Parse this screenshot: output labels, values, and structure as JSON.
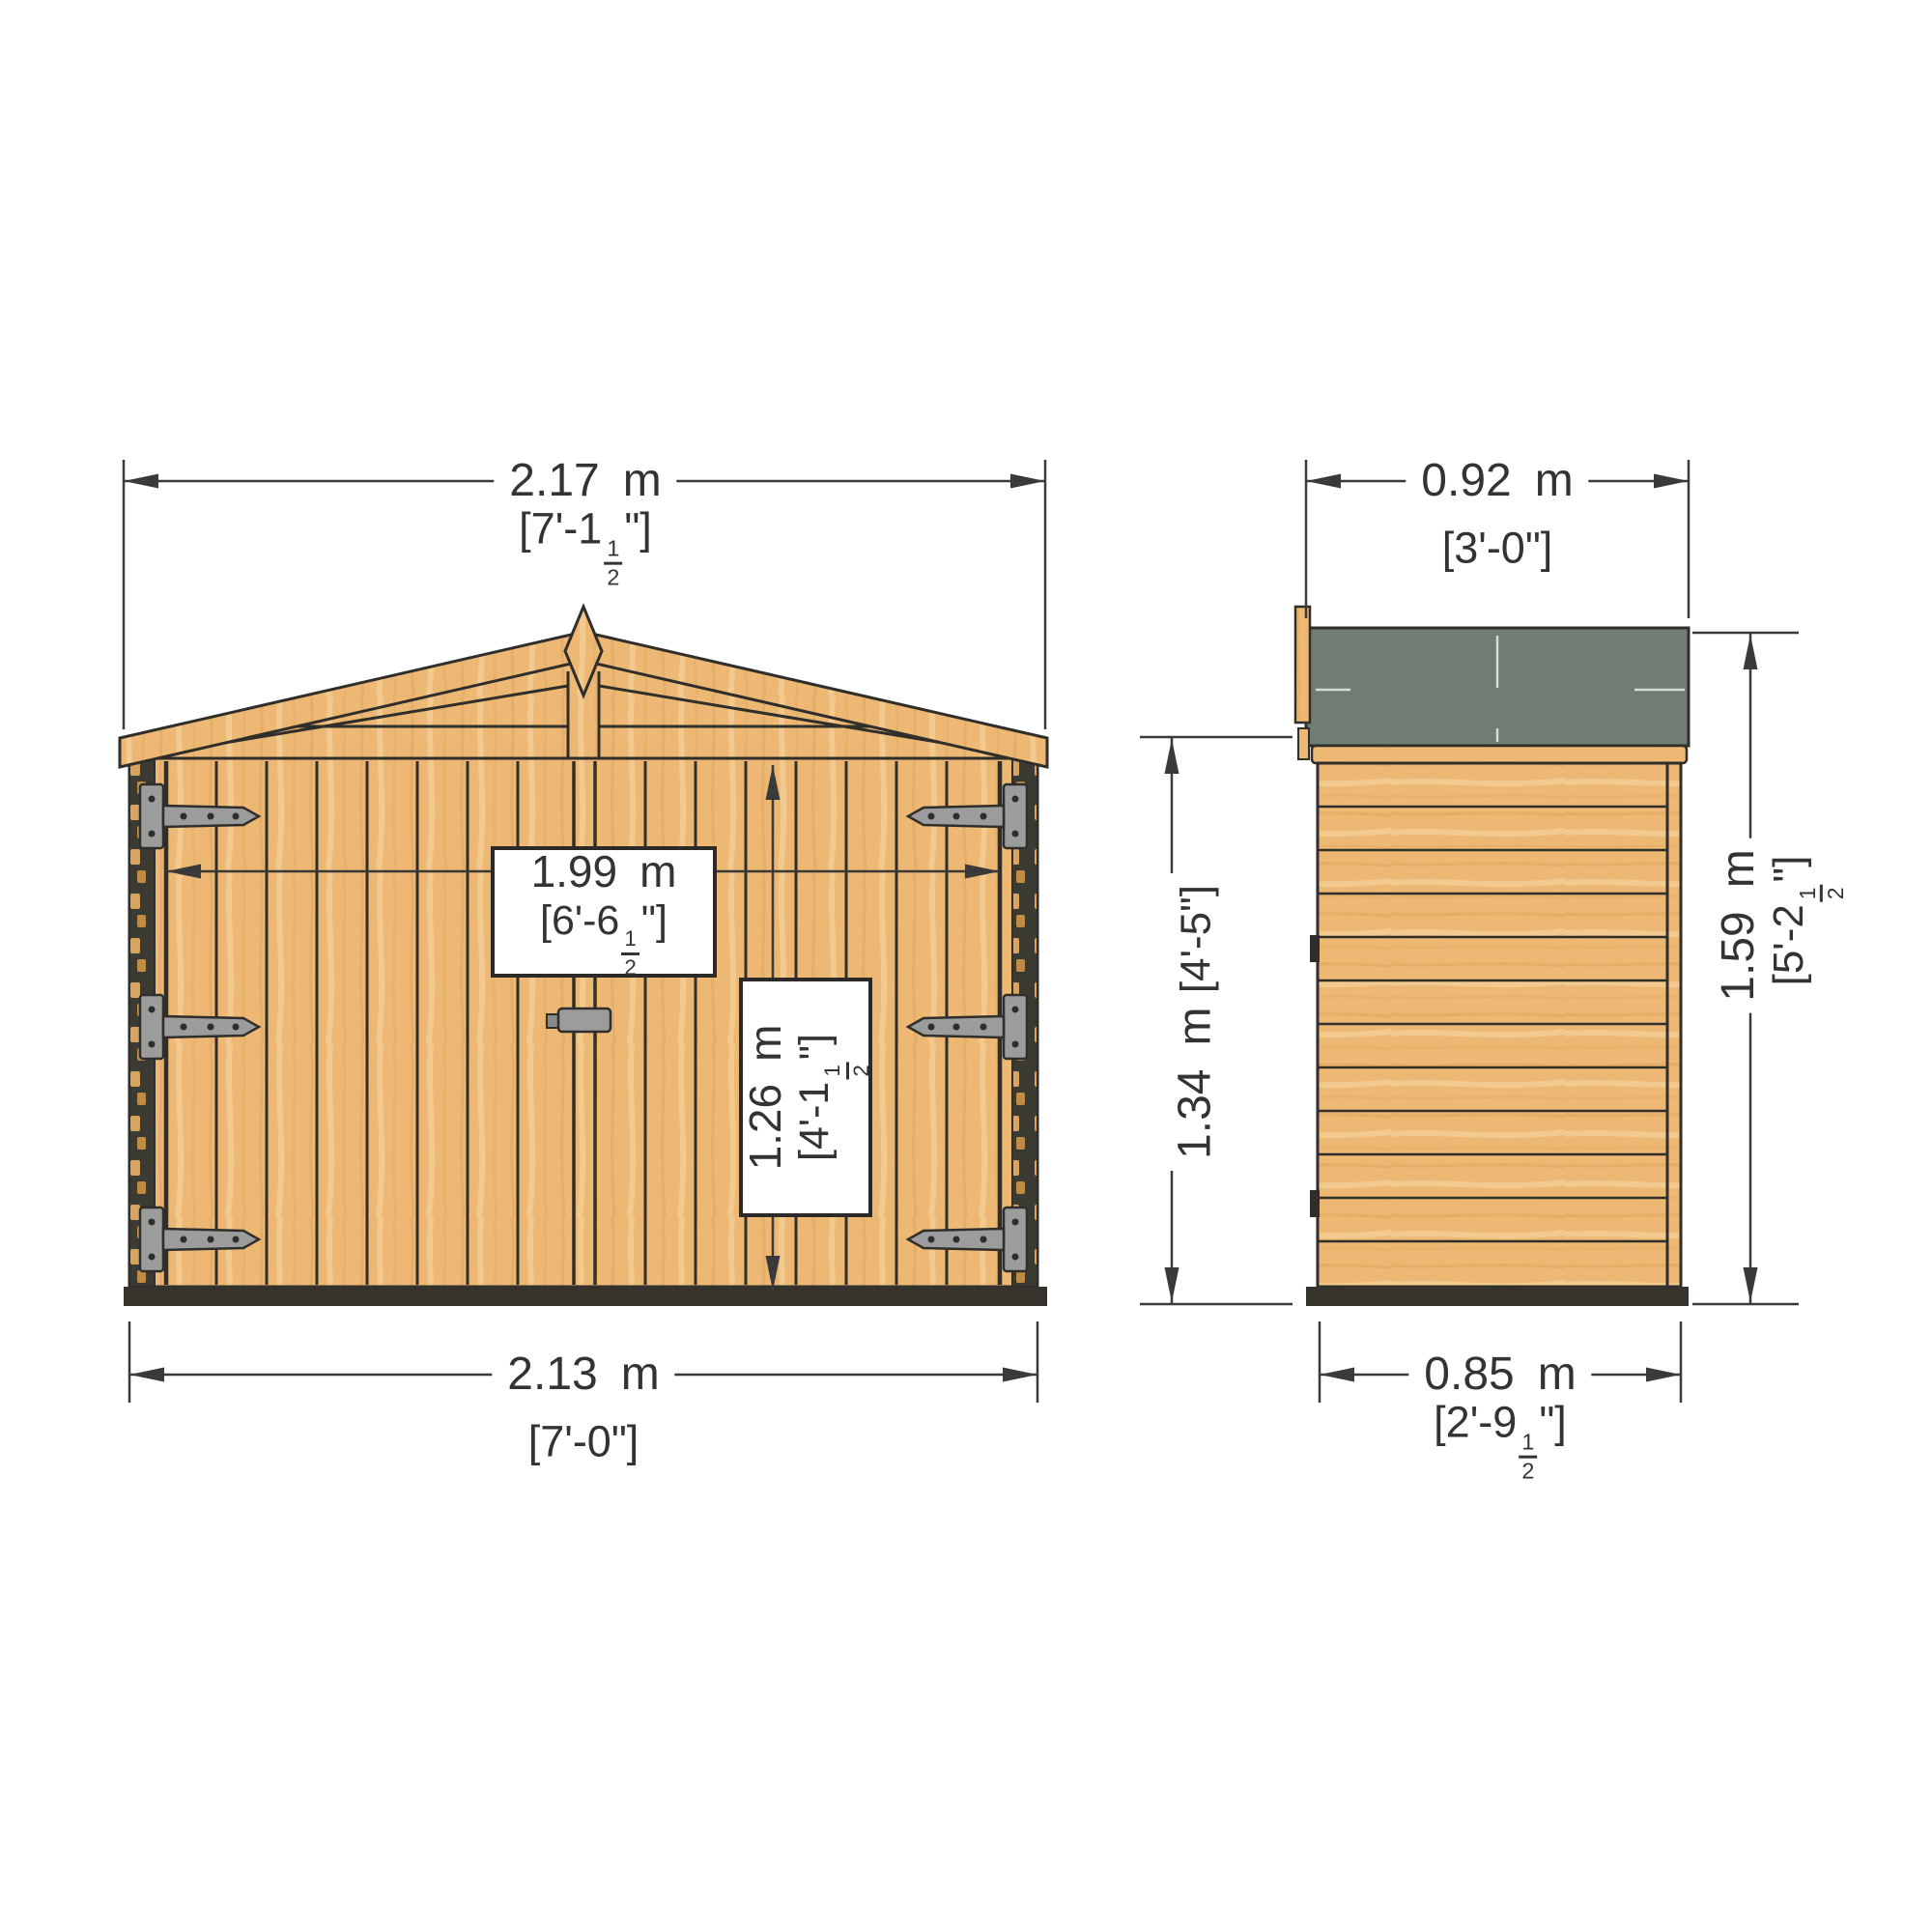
{
  "dimensions": {
    "front_overall_width": {
      "metric_value": "2.17",
      "metric_unit": "m",
      "imperial_prefix": "[7'-1",
      "fraction_numerator": "1",
      "fraction_denominator": "2",
      "imperial_suffix": "\"]"
    },
    "front_base_width": {
      "metric_value": "2.13",
      "metric_unit": "m",
      "imperial": "[7'-0\"]"
    },
    "door_opening_width": {
      "metric_value": "1.99",
      "metric_unit": "m",
      "imperial_prefix": "[6'-6",
      "fraction_numerator": "1",
      "fraction_denominator": "2",
      "imperial_suffix": "\"]"
    },
    "door_opening_height": {
      "metric_value": "1.26",
      "metric_unit": "m",
      "imperial_prefix": "[4'-1",
      "fraction_numerator": "1",
      "fraction_denominator": "2",
      "imperial_suffix": "\"]"
    },
    "side_overall_depth": {
      "metric_value": "0.92",
      "metric_unit": "m",
      "imperial": "[3'-0\"]"
    },
    "side_base_depth": {
      "metric_value": "0.85",
      "metric_unit": "m",
      "imperial_prefix": "[2'-9",
      "fraction_numerator": "1",
      "fraction_denominator": "2",
      "imperial_suffix": "\"]"
    },
    "eaves_height": {
      "metric_value": "1.34",
      "metric_unit": "m",
      "imperial": "[4'-5\"]"
    },
    "overall_height": {
      "metric_value": "1.59",
      "metric_unit": "m",
      "imperial_prefix": "[5'-2",
      "fraction_numerator": "1",
      "fraction_denominator": "2",
      "imperial_suffix": "\"]"
    }
  },
  "colors": {
    "wood": "#ecb873",
    "wood_grain_dark": "#dda35c",
    "wood_grain_light": "#f4cd95",
    "outline": "#2f2e2a",
    "roof_felt": "#6f7d72",
    "metal_gray": "#9c9c9c",
    "dimension_ink": "#333333",
    "base_shadow": "#35332c",
    "background": "#ffffff"
  }
}
